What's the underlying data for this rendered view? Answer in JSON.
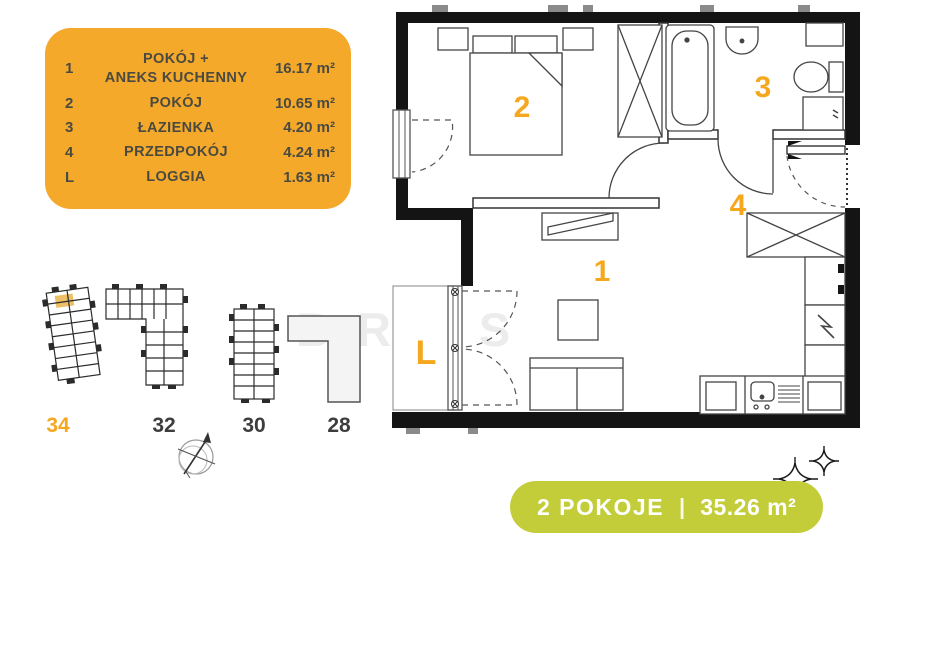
{
  "legend": {
    "rows": [
      {
        "num": "1",
        "name": "POKÓJ +\nANEKS KUCHENNY",
        "area": "16.17 m²"
      },
      {
        "num": "2",
        "name": "POKÓJ",
        "area": "10.65 m²"
      },
      {
        "num": "3",
        "name": "ŁAZIENKA",
        "area": "4.20 m²"
      },
      {
        "num": "4",
        "name": "PRZEDPOKÓJ",
        "area": "4.24 m²"
      },
      {
        "num": "L",
        "name": "LOGGIA",
        "area": "1.63 m²"
      }
    ]
  },
  "floorplan": {
    "room_labels": {
      "r1": "1",
      "r2": "2",
      "r3": "3",
      "r4": "4",
      "loggia": "L"
    }
  },
  "site": {
    "buildings": [
      {
        "label": "34",
        "highlighted": true
      },
      {
        "label": "32",
        "highlighted": false
      },
      {
        "label": "30",
        "highlighted": false
      },
      {
        "label": "28",
        "highlighted": false
      }
    ]
  },
  "badge": {
    "rooms": "2 POKOJE",
    "divider": "|",
    "area": "35.26 m²"
  },
  "watermark": "BRAS",
  "colors": {
    "accent_orange": "#F5A92B",
    "label_orange": "#F5A81E",
    "badge_green": "#C3CD39",
    "highlight_unit": "#EDC066",
    "wall_black": "#141414"
  }
}
